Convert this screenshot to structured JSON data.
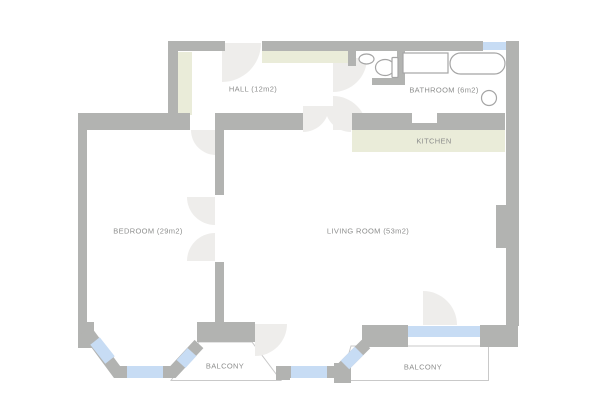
{
  "title": "Apartment floor plan",
  "rooms": {
    "hall": {
      "label": "HALL (12m2)",
      "name": "HALL",
      "area_m2": 12
    },
    "bathroom": {
      "label": "BATHROOM (6m2)",
      "name": "BATHROOM",
      "area_m2": 6
    },
    "kitchen": {
      "label": "KITCHEN",
      "name": "KITCHEN"
    },
    "bedroom": {
      "label": "BEDROOM (29m2)",
      "name": "BEDROOM",
      "area_m2": 29
    },
    "living_room": {
      "label": "LIVING ROOM (53m2)",
      "name": "LIVING ROOM",
      "area_m2": 53
    },
    "balcony_left": {
      "label": "BALCONY"
    },
    "balcony_right": {
      "label": "BALCONY"
    }
  },
  "fixtures": [
    "sink",
    "toilet",
    "washing-machine",
    "bathtub",
    "stool"
  ],
  "features": [
    "entry-door-swing",
    "double-doors-hall-living",
    "double-doors-bedroom-living",
    "balcony-door-swings",
    "bay-windows",
    "wardrobes",
    "kitchen-counter"
  ],
  "palette": {
    "background": "#ffffff",
    "wall": "#b2b3b1",
    "window_glass": "#c7dcf4",
    "cabinet_green": "#eaecd9",
    "door_swing": "#eeedeb",
    "outline": "#c9c9c9",
    "fixture_stroke": "#a5a5a5",
    "label_text": "#8d8e8d"
  }
}
